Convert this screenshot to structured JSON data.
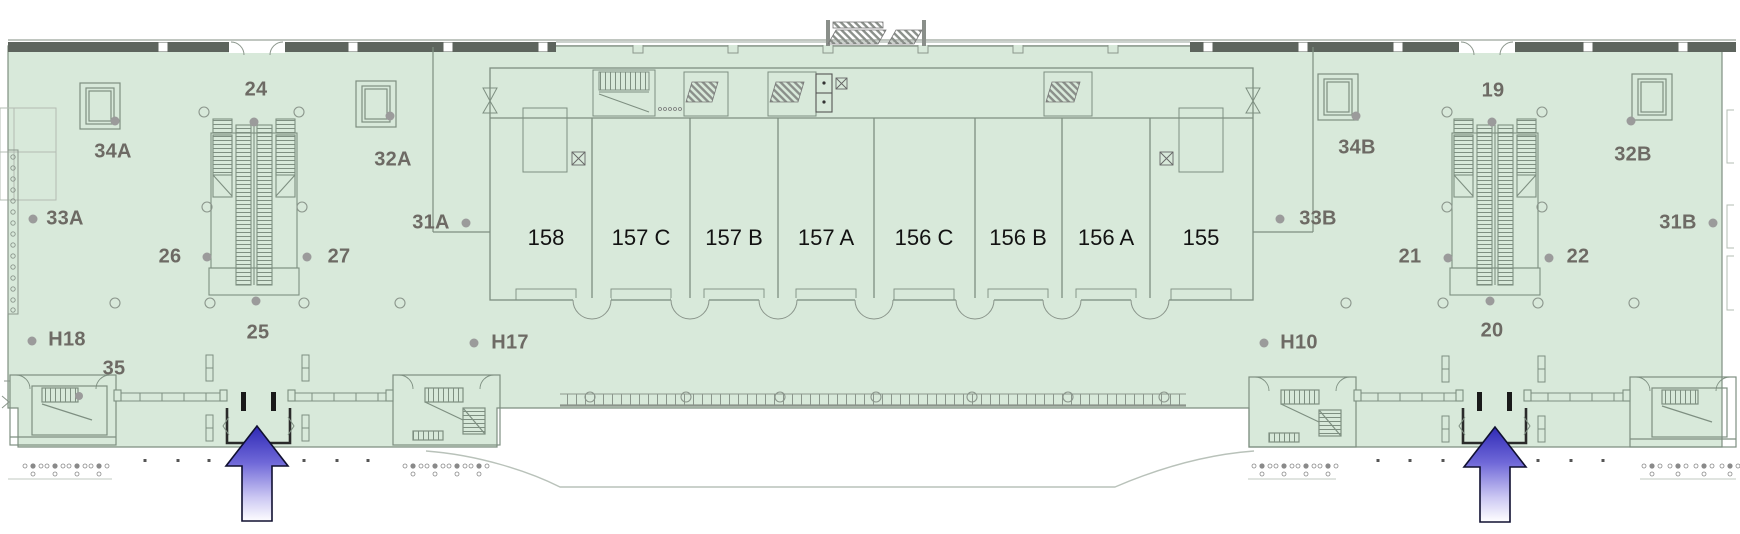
{
  "map": {
    "kind": "facility-floor-plan",
    "floor_fill": "#d8e9da",
    "wall_line": "#7e8f81",
    "exterior_wall_dark": "#5d645d",
    "zone_label_color": "#6d6a64",
    "room_label_color": "#121212",
    "column_dot_color": "#9b9b9b",
    "arrow_gradient_top": "#2e29b5",
    "arrow_gradient_bottom": "#ffffff"
  },
  "rooms": [
    "158",
    "157 C",
    "157 B",
    "157 A",
    "156 C",
    "156 B",
    "156 A",
    "155"
  ],
  "zones": [
    {
      "id": "24",
      "text": "24"
    },
    {
      "id": "34A",
      "text": "34A"
    },
    {
      "id": "32A",
      "text": "32A"
    },
    {
      "id": "33A",
      "text": "33A"
    },
    {
      "id": "31A",
      "text": "31A"
    },
    {
      "id": "26",
      "text": "26"
    },
    {
      "id": "27",
      "text": "27"
    },
    {
      "id": "25",
      "text": "25"
    },
    {
      "id": "H18",
      "text": "H18"
    },
    {
      "id": "35",
      "text": "35"
    },
    {
      "id": "H17",
      "text": "H17"
    },
    {
      "id": "19",
      "text": "19"
    },
    {
      "id": "34B",
      "text": "34B"
    },
    {
      "id": "32B",
      "text": "32B"
    },
    {
      "id": "33B",
      "text": "33B"
    },
    {
      "id": "31B",
      "text": "31B"
    },
    {
      "id": "21",
      "text": "21"
    },
    {
      "id": "22",
      "text": "22"
    },
    {
      "id": "20",
      "text": "20"
    },
    {
      "id": "H10",
      "text": "H10"
    }
  ]
}
